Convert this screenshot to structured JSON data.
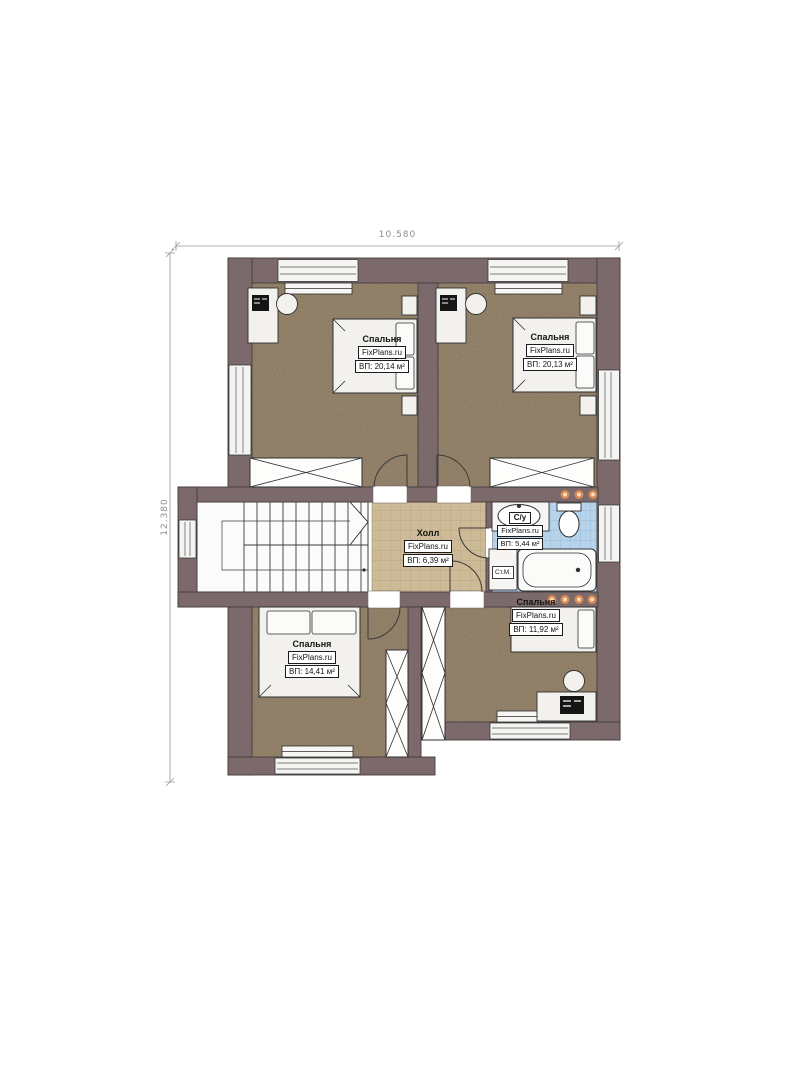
{
  "plan": {
    "title": "floor-plan",
    "dimensions": {
      "width_label": "10.580",
      "height_label": "12.380"
    },
    "brand": "FixPlans.ru",
    "rooms": [
      {
        "id": "bedroom-top-left",
        "name": "Спальня",
        "area": "ВП: 20,14 м²"
      },
      {
        "id": "bedroom-top-right",
        "name": "Спальня",
        "area": "ВП: 20,13 м²"
      },
      {
        "id": "hall",
        "name": "Холл",
        "area": "ВП: 6,39 м²"
      },
      {
        "id": "bathroom",
        "name": "С/у",
        "area": "ВП: 5,44 м²"
      },
      {
        "id": "bedroom-bottom-right",
        "name": "Спальня",
        "area": "ВП: 11,92 м²"
      },
      {
        "id": "bedroom-bottom-left",
        "name": "Спальня",
        "area": "ВП: 14,41 м²"
      }
    ],
    "labels": {
      "washing_machine": "Ст.М."
    },
    "colors": {
      "wall": "#7c696b",
      "bedroom_floor": "#8d7a60",
      "hall_tile": "#cdbb98",
      "bath_tile": "#b6d3ea",
      "furniture": "#f2f1ee",
      "spotlight": "#d98a52",
      "dimension_text": "#8d8d8d"
    }
  }
}
